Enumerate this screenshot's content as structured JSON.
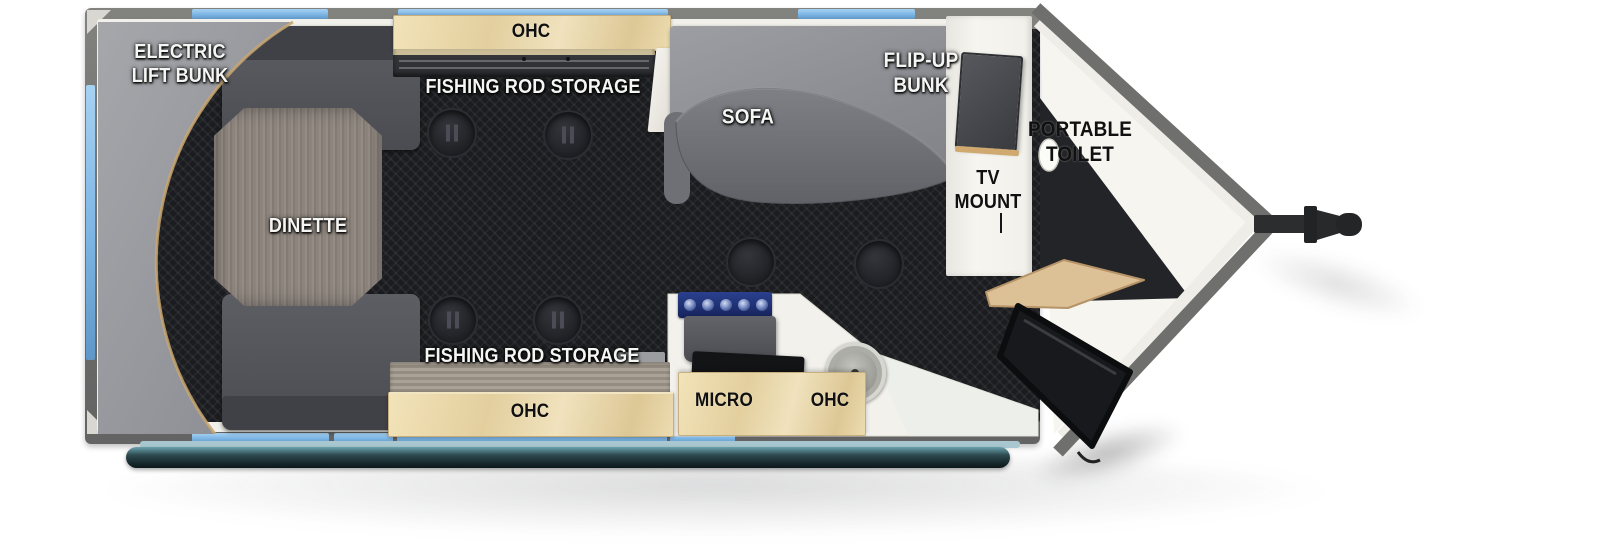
{
  "title": "Travel trailer floorplan (toy hauler with V-nose)",
  "floorplan": {
    "labels": {
      "electric_lift_bunk_1": "ELECTRIC",
      "electric_lift_bunk_2": "LIFT BUNK",
      "ohc_top": "OHC",
      "fishing_rod_storage_top": "FISHING ROD STORAGE",
      "sofa": "SOFA",
      "flip_up_bunk_1": "FLIP-UP",
      "flip_up_bunk_2": "BUNK",
      "dinette": "DINETTE",
      "tv_mount_1": "TV",
      "tv_mount_2": "MOUNT",
      "portable_toilet_1": "PORTABLE",
      "portable_toilet_2": "TOILET",
      "micro": "MICRO",
      "ohc_kitchen": "OHC",
      "fishing_rod_storage_bottom": "FISHING ROD STORAGE",
      "ohc_bottom": "OHC"
    },
    "colors": {
      "window_blue": "#7db5e4",
      "wall_gray": "#70706e",
      "inner_lining": "#f1f0ea",
      "floor_dark": "#1b1c1f",
      "wood_cabinet": "#e9d8ac",
      "wood_trim": "#c9a66d",
      "sofa_gray": "#8e9094",
      "bench_gray": "#4d4f54",
      "counter_white": "#f2f1ec",
      "rollbar_teal": "#2e4a50",
      "door_black": "#17181b"
    }
  }
}
